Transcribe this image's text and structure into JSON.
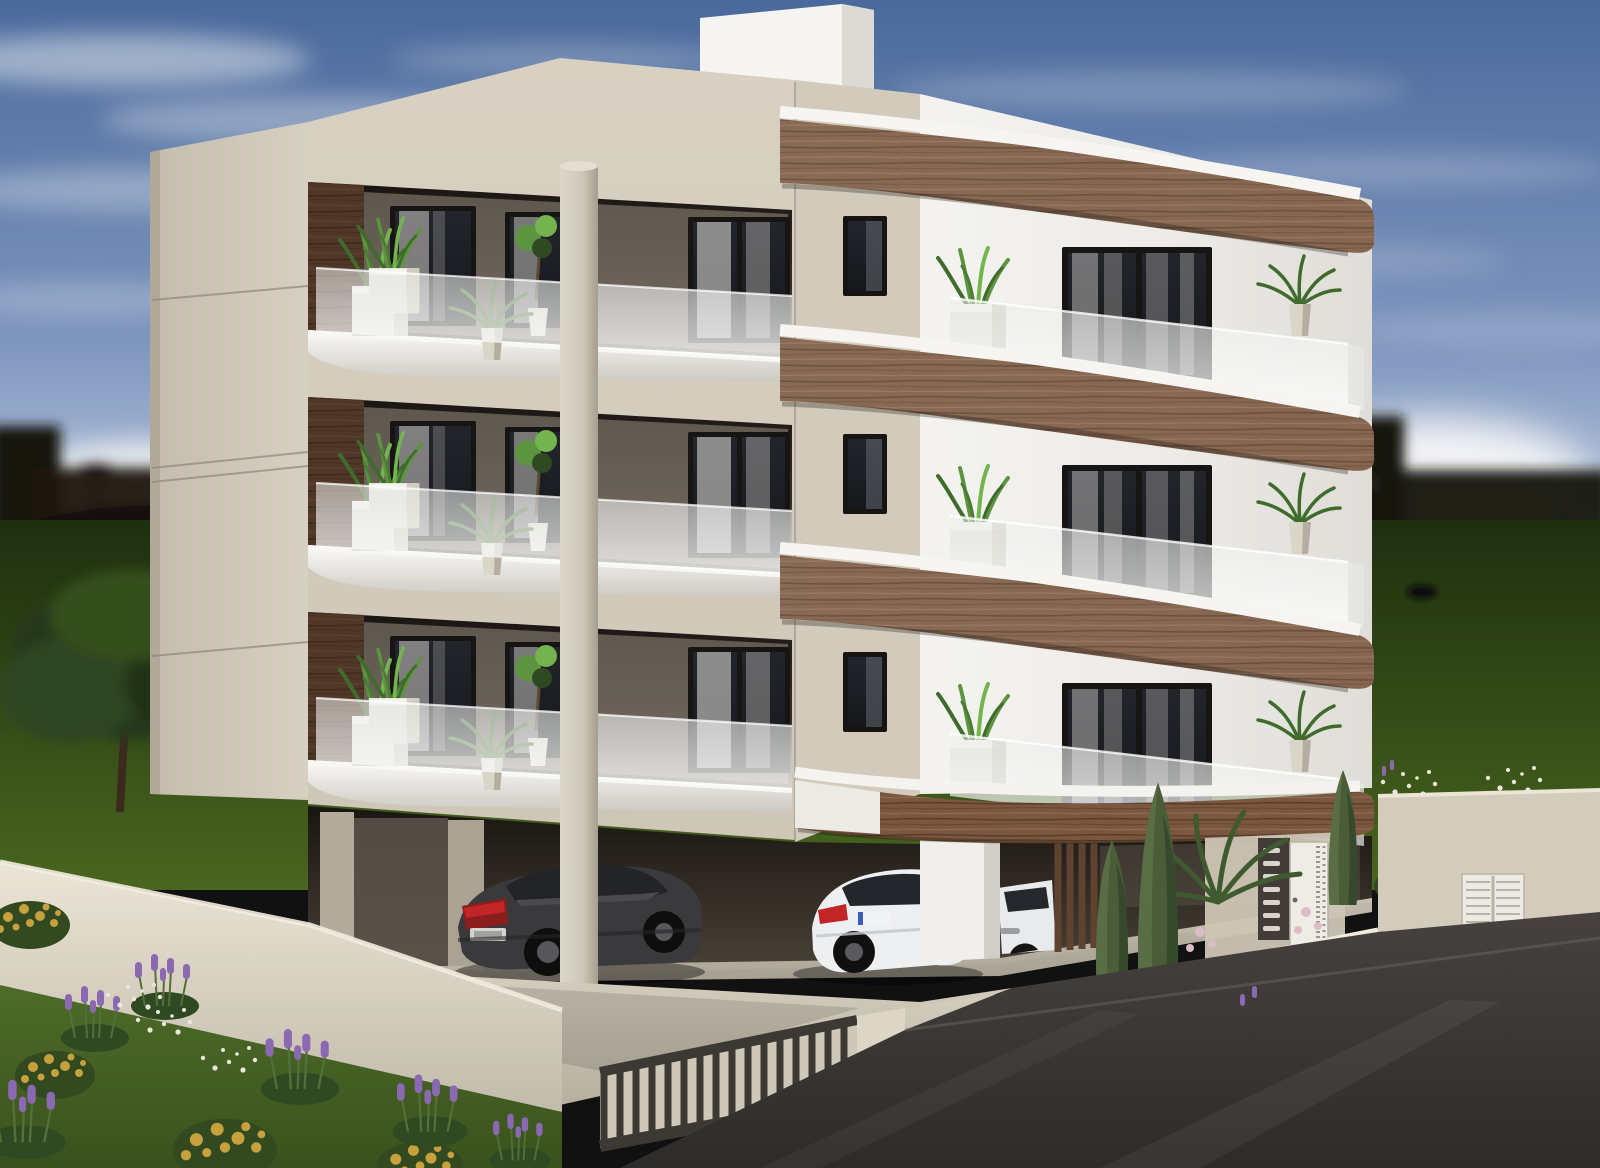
{
  "scene": {
    "title": "3D exterior architectural rendering of a modern three-storey apartment building seen from a street corner on a partly cloudy day",
    "time_of_day": "daytime",
    "weather": "blue sky with cirrus and cumulus clouds",
    "view": "elevated corner perspective, two facades visible"
  },
  "building": {
    "storeys_above_carport": 3,
    "ground_floor": "open carport parking with round and square columns",
    "roof": "flat roof with white stair bulkhead",
    "left_facade": "beige stone-look cladding with three recessed balconies, dark wood accent panels, frosted glass balustrades",
    "front_facade": "white plaster with three curved walnut wood fascia bands, frosted glass balustrades, black-framed glazing",
    "balcony_planting": "potted ornamental grasses, ferns and small palms"
  },
  "vehicles": [
    {
      "name": "dark-grey-coupe",
      "location": "carport left bay",
      "detail": "red tail lights, unreadable licence plate"
    },
    {
      "name": "white-coupe",
      "location": "carport centre bay",
      "detail": "red tail lights, unreadable licence plate"
    },
    {
      "name": "white-car-partial",
      "location": "entrance bay, mostly hidden behind pier"
    }
  ],
  "entrance": {
    "pedestrian_door": "white decorated door with perforated strip",
    "intercom_panel": "dark grey panel with seven letterbox slots",
    "planting": "two tall cypress trees, sago palm, pale pink blossoms, magenta bougainvillea"
  },
  "boundary": {
    "wall": "low beige rendered wall around the plot",
    "fence": "dark metal vertical-bar fence above the street-side wall",
    "side_gate": "white louvred double hatch in right-hand wall",
    "road": "dark asphalt street in the right foreground"
  },
  "garden": {
    "foreground": "lawn with lavender bushes, yellow shrubs and white daisies",
    "tree": "small leafy tree at the left edge",
    "background": "dark green field with silhouetted trees and low-rise buildings on the horizon"
  },
  "palette": {
    "sky_top": "#4a699c",
    "sky_mid": "#7e96bf",
    "sky_horizon": "#ccd6e3",
    "cloud_bright": "#eef0f2",
    "cloud_shadow": "#9aa2ae",
    "silhouette_dark": "#17130f",
    "field_dark": "#1e2f0f",
    "field_light": "#49661f",
    "lawn_green": "#4e6b28",
    "facade_white": "#f2f1ed",
    "facade_white_dim": "#d9d6d0",
    "facade_beige": "#cec7b7",
    "facade_beige_dark": "#a59e8f",
    "wood_brown": "#7b573f",
    "wood_brown_dark": "#5a3e2b",
    "wood_brown_light": "#936f55",
    "window_glass": "#15171b",
    "frame_black": "#171513",
    "curtain_gray": "#b5b2b0",
    "frosted_glass": "#eceeec",
    "plant_green": "#5d9440",
    "plant_green_dark": "#2f4a22",
    "cypress_green": "#4a5c38",
    "planter_white": "#e3e0d6",
    "pavement": "#d6cfbf",
    "pavement_dark": "#b7b0a0",
    "wall_beige": "#ded7c7",
    "road_asphalt": "#3b3734",
    "fence_dark": "#3c3834",
    "car_dark_gray": "#3a393b",
    "car_white": "#edeff1",
    "taillight_red": "#c22525",
    "plate_blue": "#3b5bbf",
    "lavender_purple": "#8a68b2",
    "flower_yellow": "#c6a13d",
    "flower_white": "#eae8dc",
    "bougainvillea_pink": "#cb4fc0",
    "blossom_pink": "#dcbcc6",
    "tree_green": "#33491f",
    "trunk_brown": "#3f2e20"
  }
}
